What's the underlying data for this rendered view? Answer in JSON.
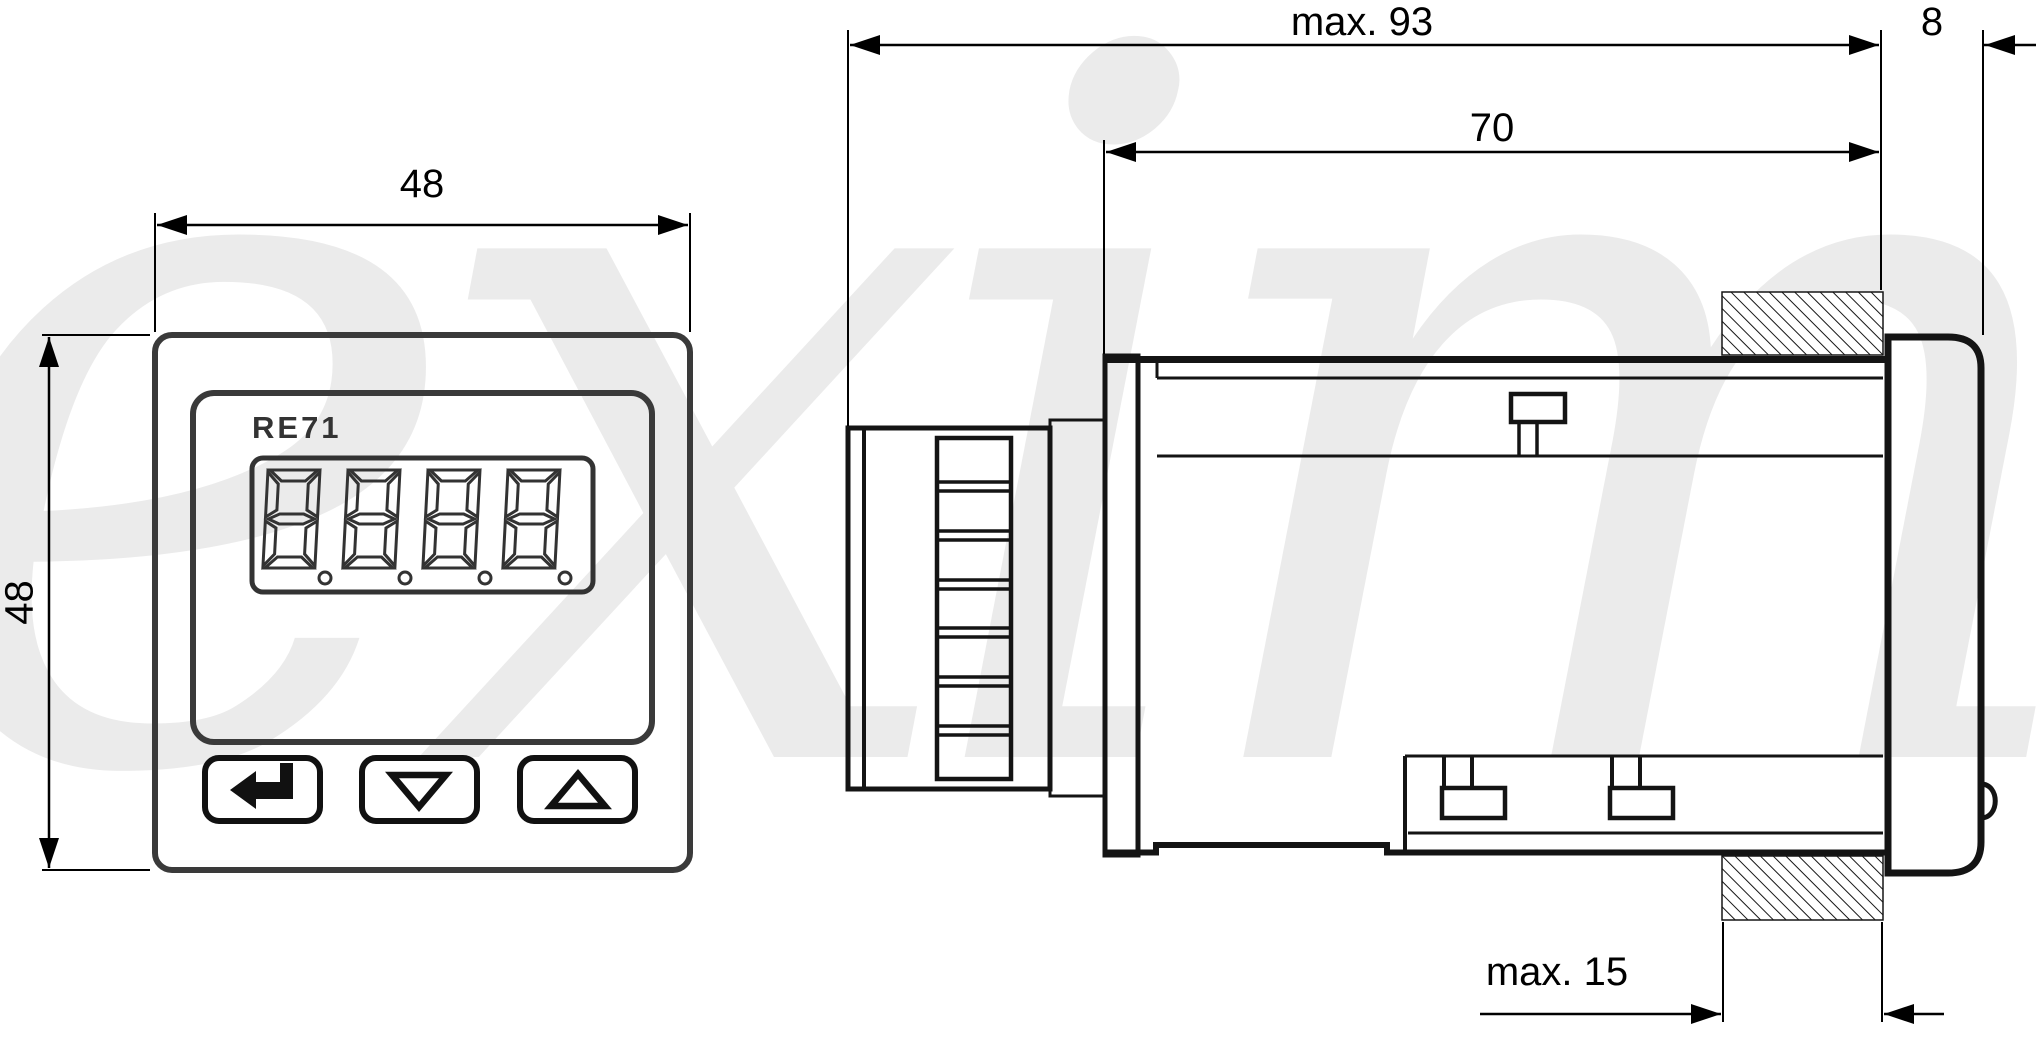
{
  "watermark_text": "eximus",
  "front_view": {
    "model_label": "RE71",
    "display_value": "8888",
    "width_dim": "48",
    "height_dim": "48",
    "buttons": [
      {
        "icon": "enter-arrow-icon"
      },
      {
        "icon": "down-triangle-icon"
      },
      {
        "icon": "up-triangle-icon"
      }
    ]
  },
  "side_view": {
    "overall_depth_dim": "max. 93",
    "front_bezel_depth_dim": "8",
    "behind_panel_depth_dim": "70",
    "panel_thickness_dim": "max. 15"
  }
}
